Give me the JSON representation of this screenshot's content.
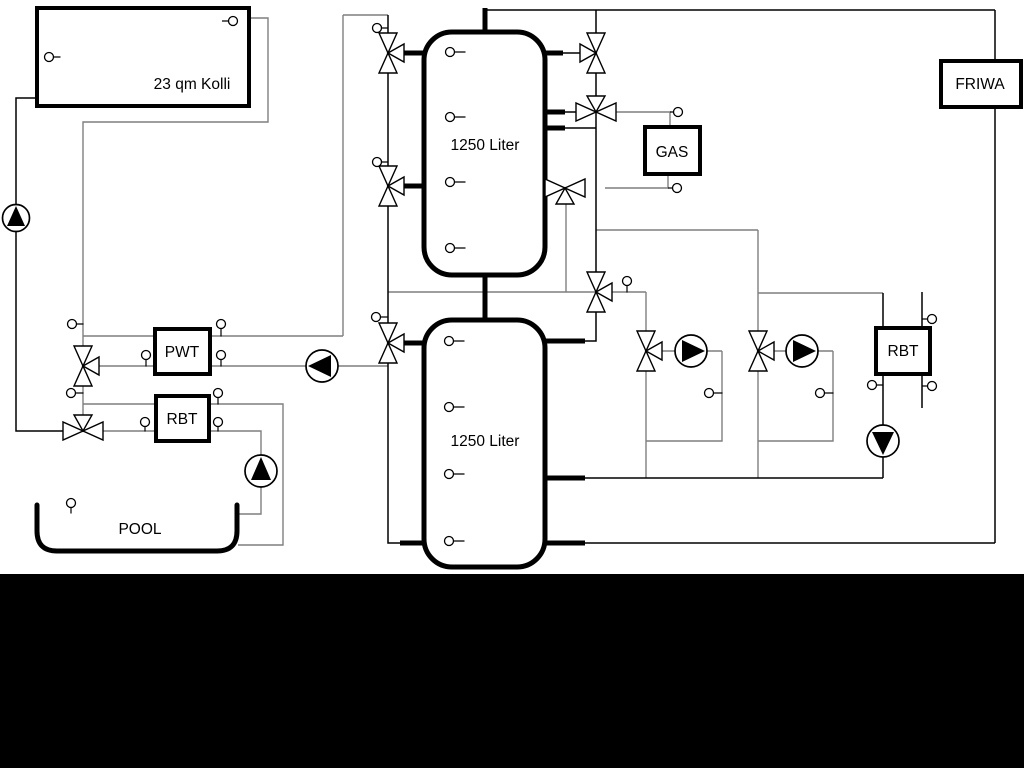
{
  "diagram": {
    "title": "heating-system-schematic",
    "labels": {
      "collector": "23 qm Kolli",
      "tank_top": "1250 Liter",
      "tank_bottom": "1250 Liter",
      "gas": "GAS",
      "friwa": "FRIWA",
      "pwt": "PWT",
      "rbt_left": "RBT",
      "rbt_right": "RBT",
      "pool": "POOL"
    },
    "colors": {
      "pipe_primary": "#000000",
      "pipe_secondary": "#7f7f7f",
      "component_fill": "#ffffff",
      "background": "#ffffff",
      "footer_bar": "#000000"
    }
  }
}
